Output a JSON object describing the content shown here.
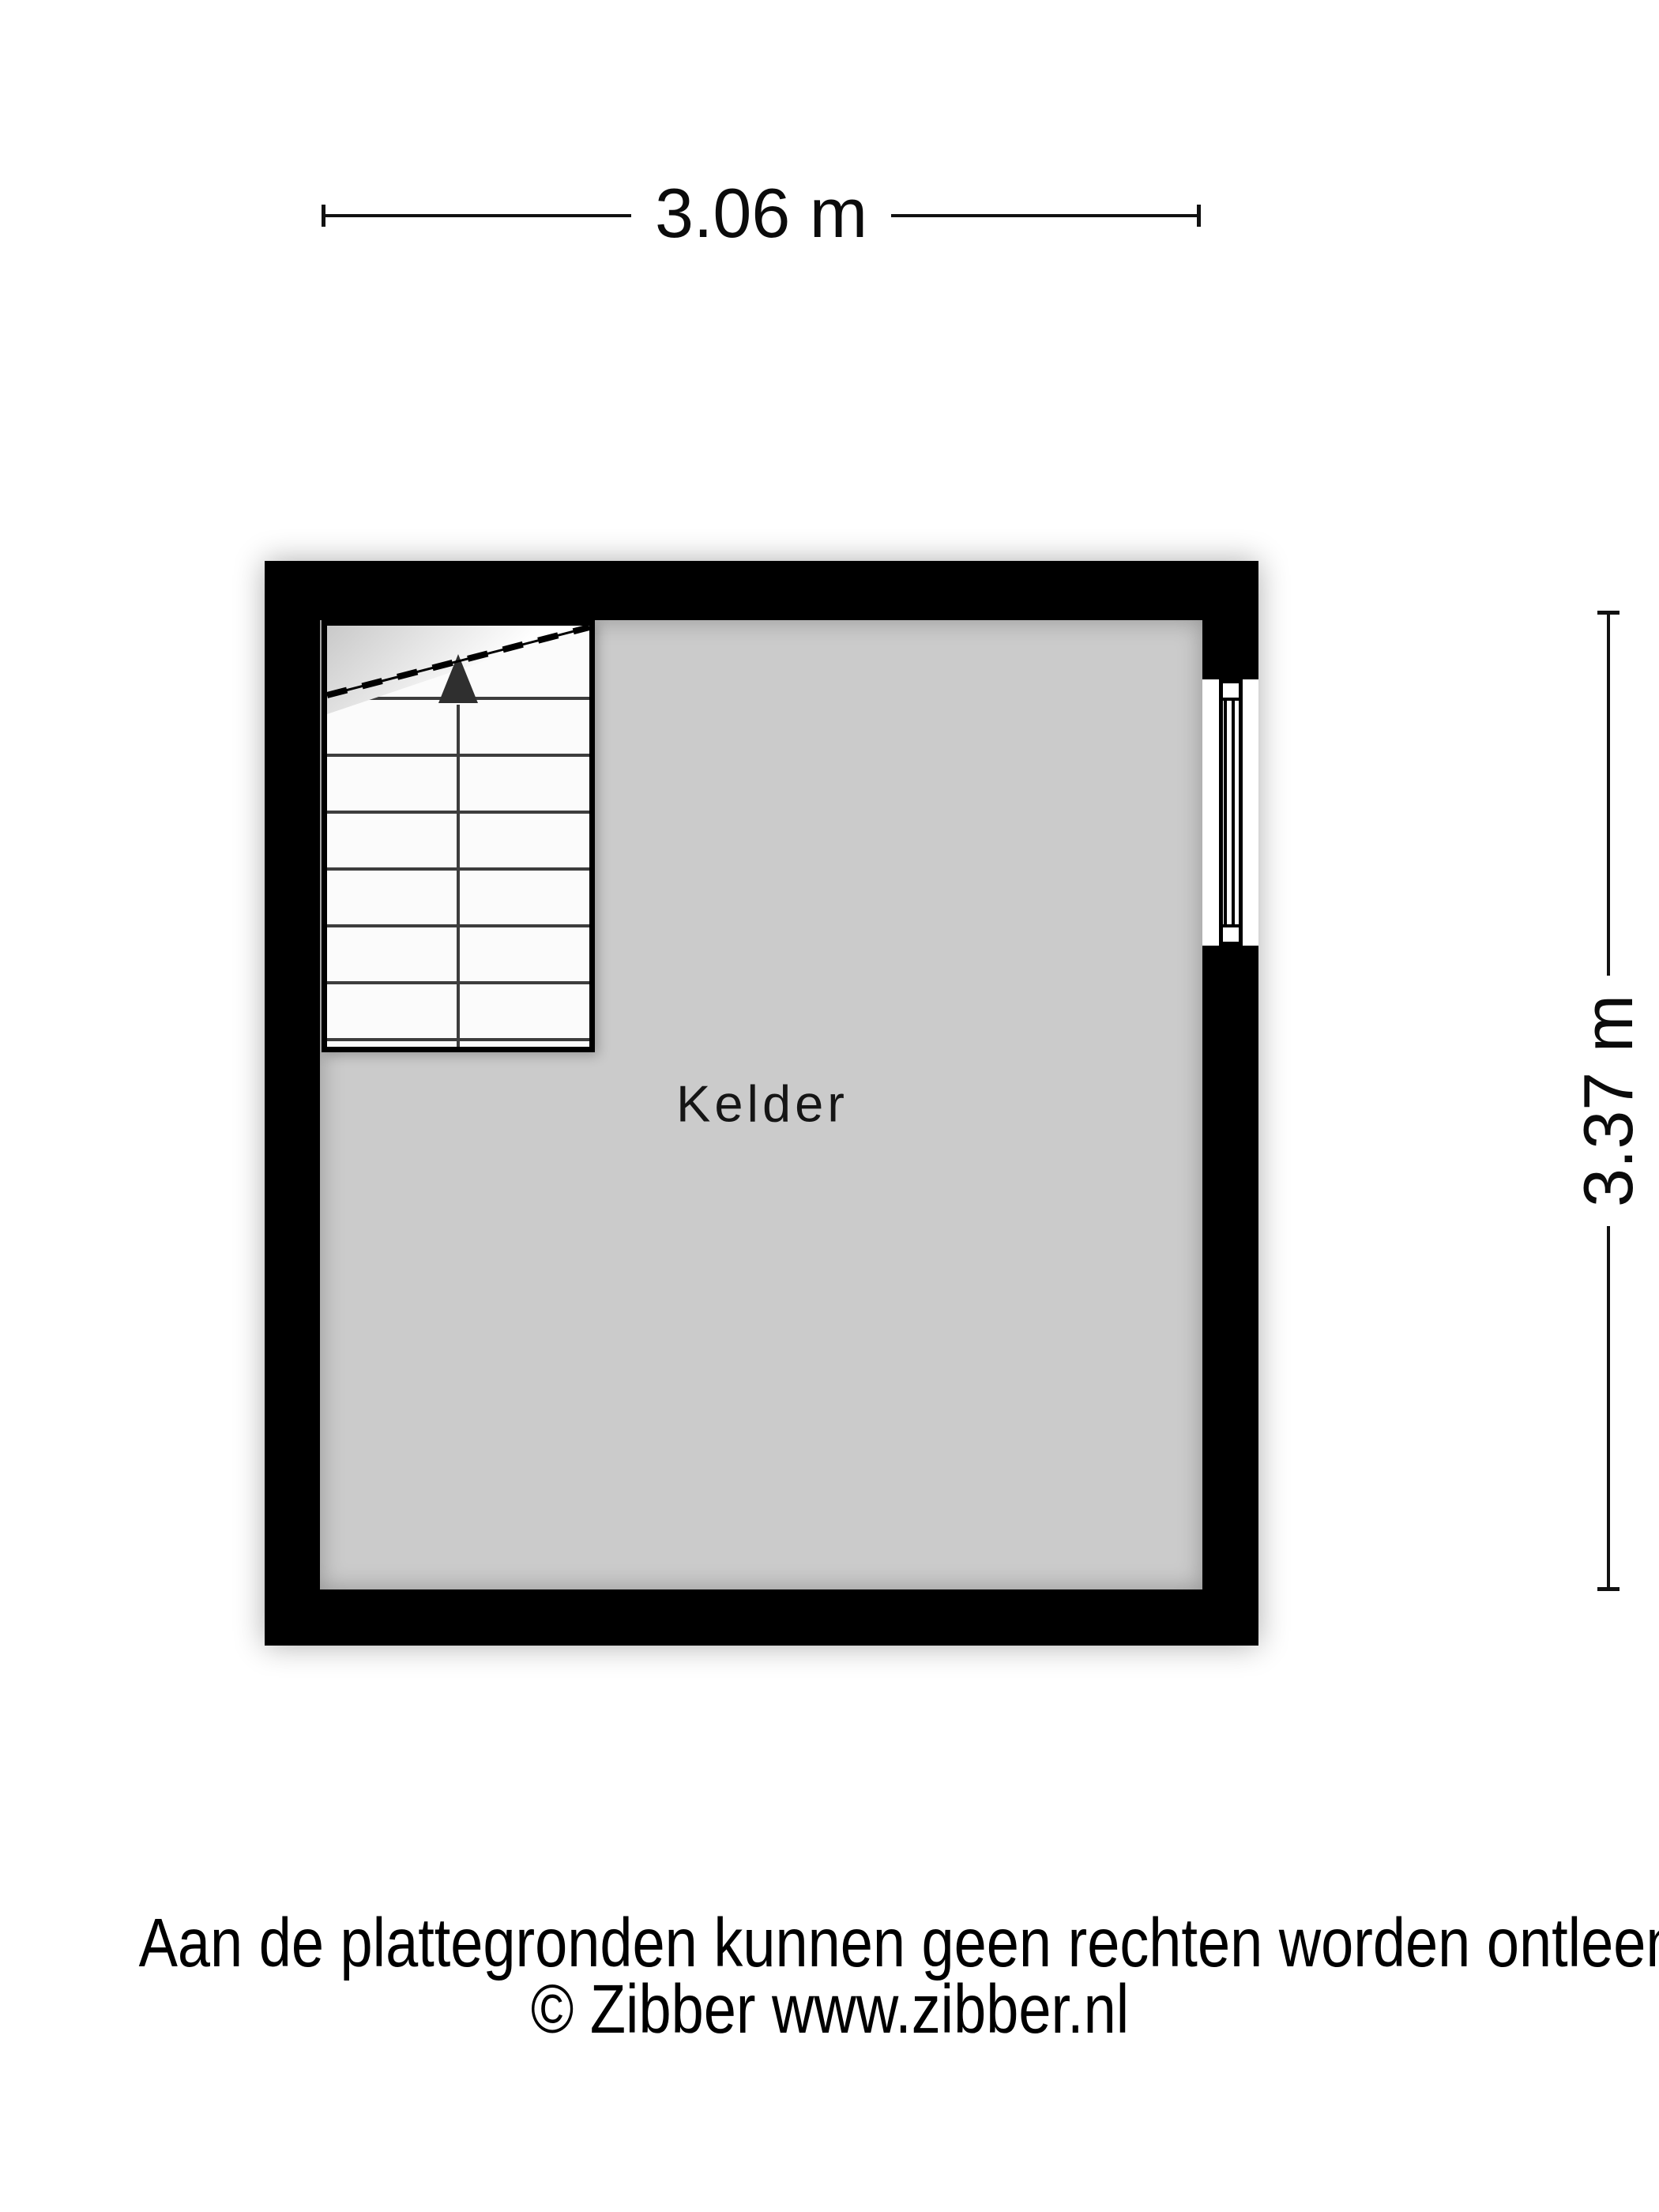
{
  "dimensions": {
    "width_label": "3.06 m",
    "height_label": "3.37 m"
  },
  "room": {
    "label": "Kelder"
  },
  "footer": {
    "disclaimer": "Aan de plattegronden kunnen geen rechten worden ontleend",
    "copyright": "© Zibber www.zibber.nl"
  },
  "colors": {
    "wall": "#000000",
    "floor": "#cbcbcb",
    "background": "#ffffff",
    "dimension_line": "#111111"
  }
}
